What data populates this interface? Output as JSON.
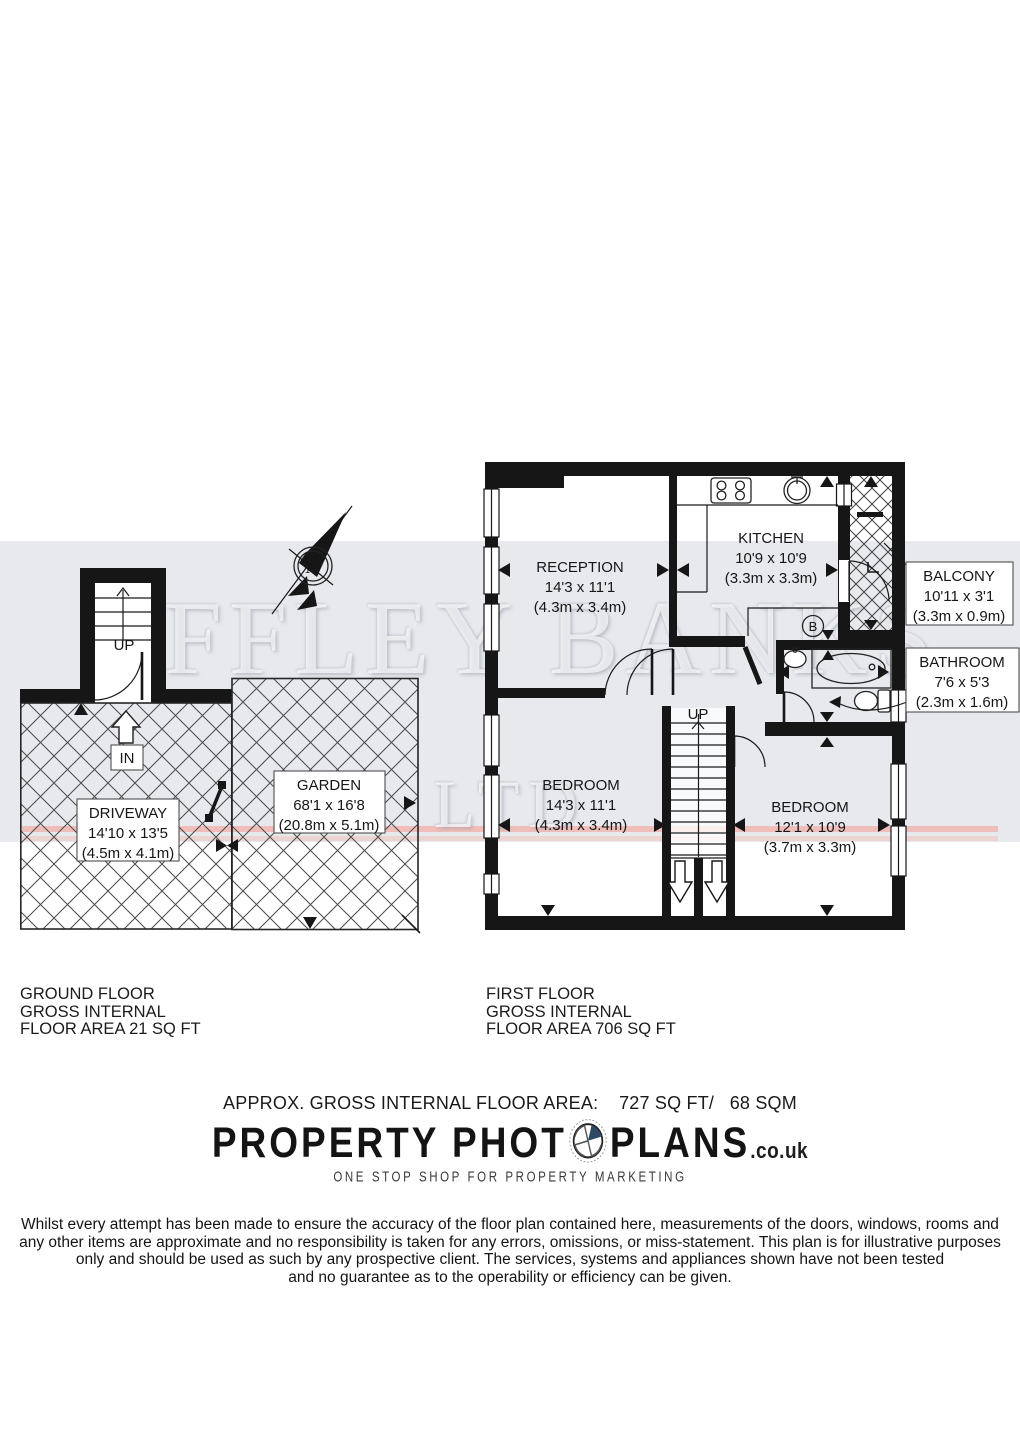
{
  "watermark": {
    "line1": "OFFLEY BANKS",
    "line2": "LTD"
  },
  "compass": {
    "north_label": "N"
  },
  "ground_floor": {
    "stairs_label": "UP",
    "entrance_label": "IN",
    "driveway": {
      "name": "DRIVEWAY",
      "size_imperial": "14'10 x 13'5",
      "size_metric": "(4.5m x 4.1m)"
    },
    "garden": {
      "name": "GARDEN",
      "size_imperial": "68'1 x 16'8",
      "size_metric": "(20.8m x 5.1m)"
    },
    "caption_line1": "GROUND FLOOR",
    "caption_line2": "GROSS INTERNAL",
    "caption_line3": "FLOOR AREA 21 SQ FT"
  },
  "first_floor": {
    "stairs_label": "UP",
    "boiler_label": "B",
    "reception": {
      "name": "RECEPTION",
      "size_imperial": "14'3 x 11'1",
      "size_metric": "(4.3m x 3.4m)"
    },
    "kitchen": {
      "name": "KITCHEN",
      "size_imperial": "10'9 x 10'9",
      "size_metric": "(3.3m x 3.3m)"
    },
    "balcony": {
      "name": "BALCONY",
      "size_imperial": "10'11 x 3'1",
      "size_metric": "(3.3m x 0.9m)"
    },
    "bathroom": {
      "name": "BATHROOM",
      "size_imperial": "7'6 x 5'3",
      "size_metric": "(2.3m x 1.6m)"
    },
    "bedroom1": {
      "name": "BEDROOM",
      "size_imperial": "14'3 x 11'1",
      "size_metric": "(4.3m x 3.4m)"
    },
    "bedroom2": {
      "name": "BEDROOM",
      "size_imperial": "12'1 x 10'9",
      "size_metric": "(3.7m x 3.3m)"
    },
    "caption_line1": "FIRST FLOOR",
    "caption_line2": "GROSS INTERNAL",
    "caption_line3": "FLOOR AREA 706 SQ FT"
  },
  "summary": {
    "text": "APPROX. GROSS INTERNAL FLOOR AREA:    727 SQ FT/   68 SQM"
  },
  "logo": {
    "word1": "PROPERTY PHOT",
    "word2": "PLANS",
    "domain": ".co.uk",
    "tagline": "ONE STOP SHOP FOR PROPERTY MARKETING"
  },
  "disclaimer": {
    "line1": "Whilst every attempt has been made to ensure the accuracy of the floor plan contained here, measurements of the doors, windows, rooms and",
    "line2": "any other items are approximate and no responsibility is taken for any errors, omissions, or miss-statement. This plan is for illustrative purposes",
    "line3": "only and should be used as such by any prospective client. The services, systems and appliances shown have not been tested",
    "line4": "and no guarantee as to the operability or efficiency can be given."
  },
  "colors": {
    "band": "#e7e9ed",
    "wall": "#161616",
    "accent_red": "#fc7a66",
    "logo_blue": "#2c4a68"
  }
}
